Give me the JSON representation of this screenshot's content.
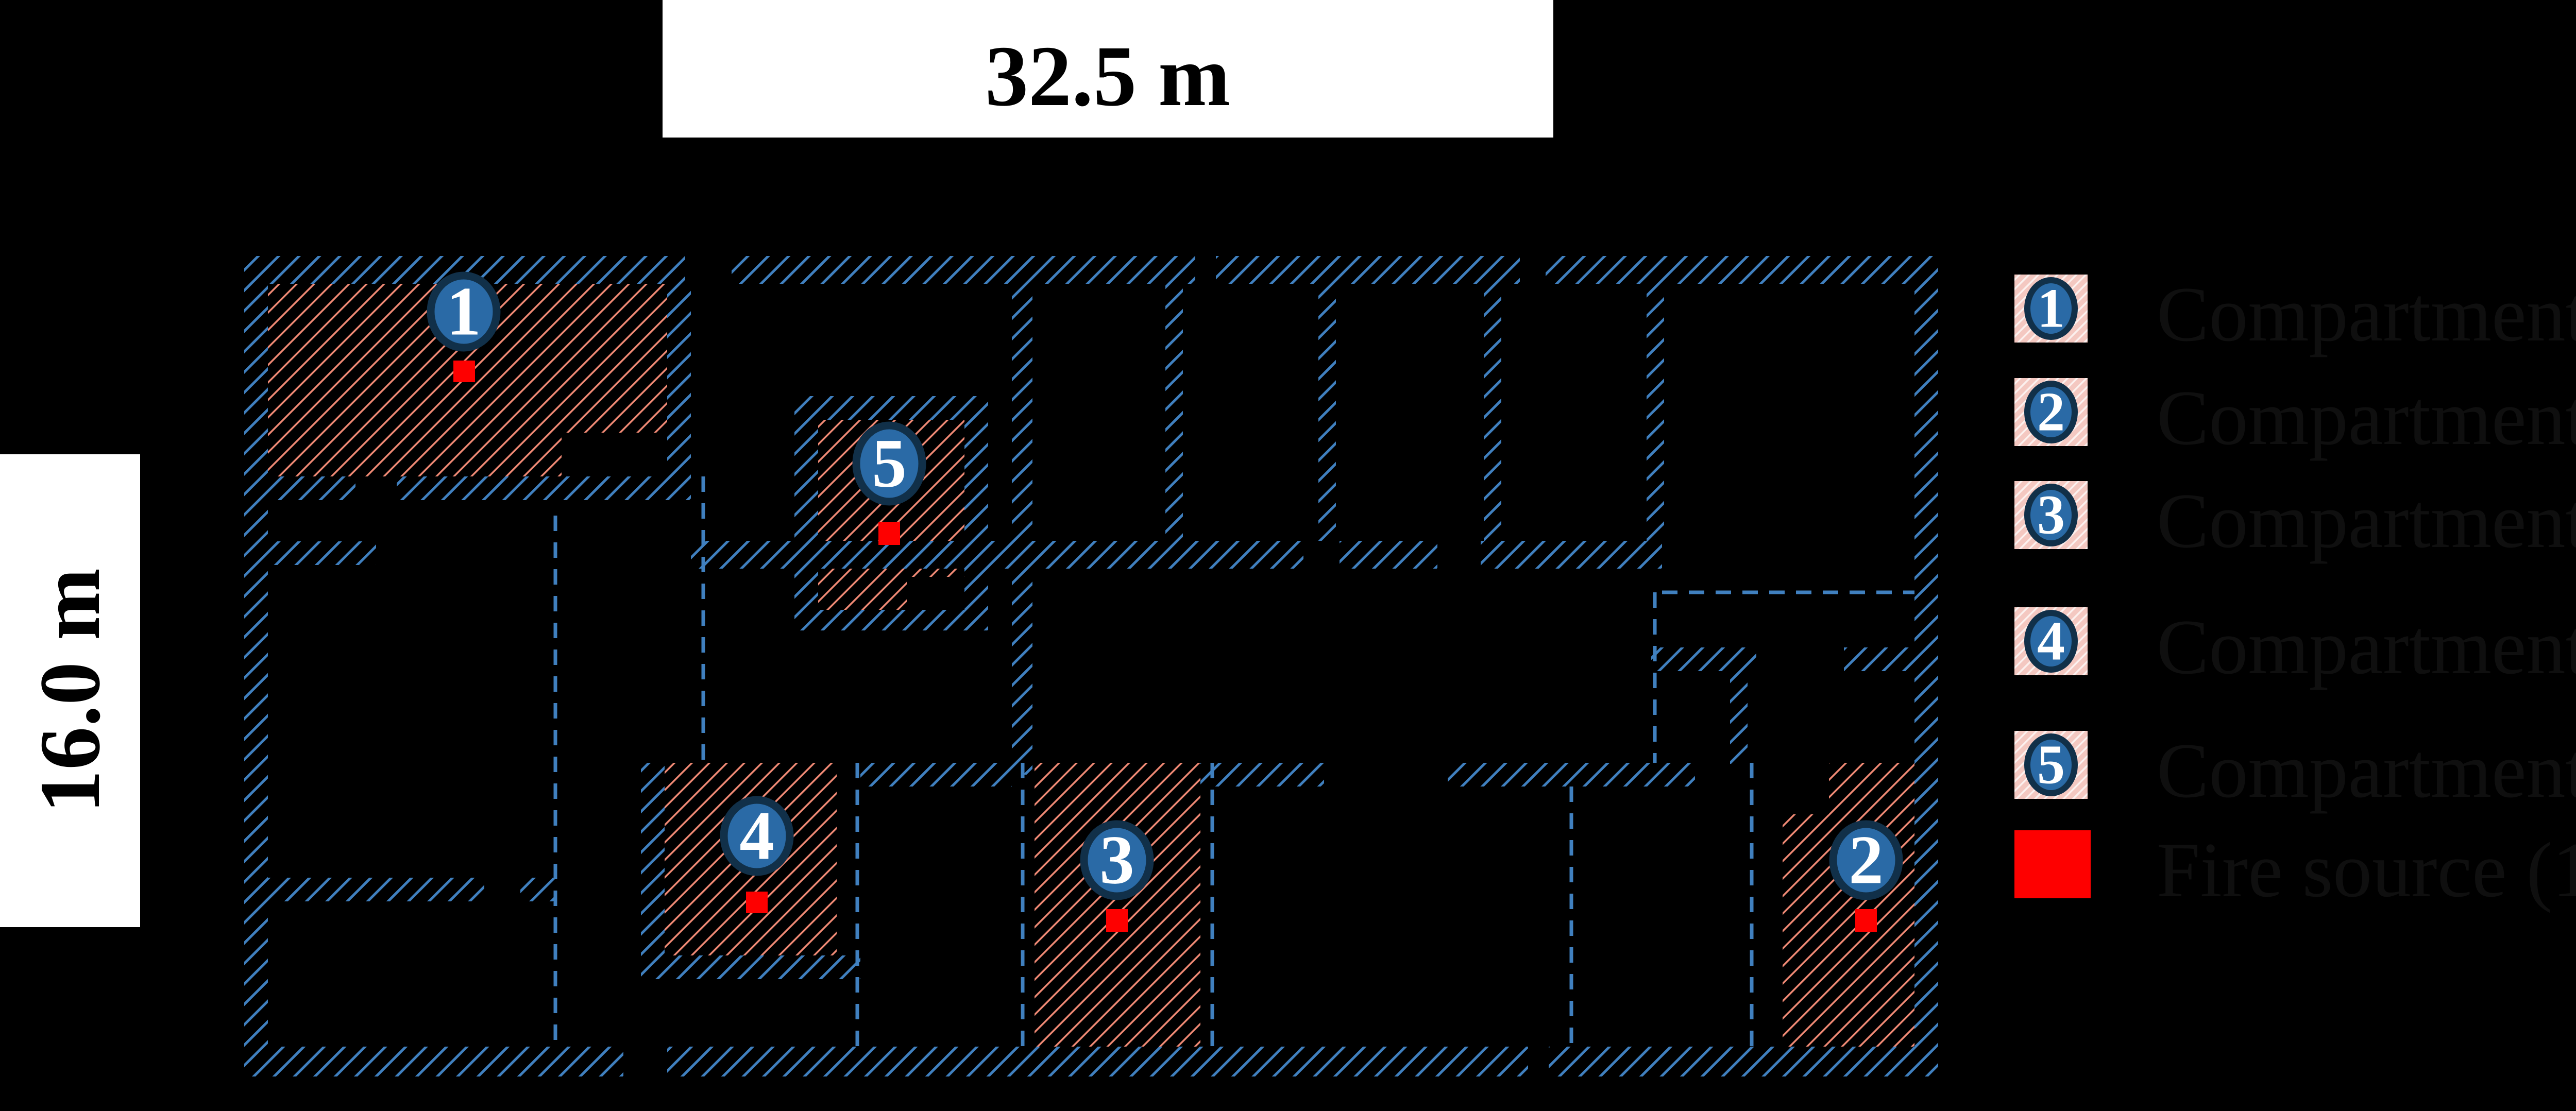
{
  "figure": {
    "type": "building-floor-plan",
    "background": "#000000",
    "width_label": "32.5 m",
    "height_label": "16.0 m"
  },
  "scale_bars": {
    "top": {
      "label": "32.5 m"
    },
    "left": {
      "label": "16.0 m"
    }
  },
  "legend": {
    "items": [
      {
        "number": "1",
        "label": "Compartment 1 (30.11 m²)",
        "swatch": "pink-hatched-with-badge"
      },
      {
        "number": "2",
        "label": "Compartment 2 (19.69 m²)",
        "swatch": "pink-hatched-with-badge"
      },
      {
        "number": "3",
        "label": "Compartment 3 (19.39 m²)",
        "swatch": "pink-hatched-with-badge"
      },
      {
        "number": "4",
        "label": "Compartment 4 (11.02 m²)",
        "swatch": "pink-hatched-with-badge"
      },
      {
        "number": "5",
        "label": "Compartment 5 (8.03 m²)",
        "swatch": "pink-hatched-with-badge"
      },
      {
        "number": "",
        "label": "Fire source (1 m²)",
        "swatch": "red-filled"
      }
    ]
  },
  "markers": [
    {
      "number": "1",
      "compartment": "Compartment 1"
    },
    {
      "number": "2",
      "compartment": "Compartment 2"
    },
    {
      "number": "3",
      "compartment": "Compartment 3"
    },
    {
      "number": "4",
      "compartment": "Compartment 4"
    },
    {
      "number": "5",
      "compartment": "Compartment 5"
    }
  ],
  "colors": {
    "wall_hatch_blue": "#4080bf",
    "compartment_hatch_salmon": "#f28b76",
    "marker_fill_blue": "#2a6aa6",
    "marker_ring_navy": "#113049",
    "legend_swatch_pink": "#f4c8c1",
    "fire_source_red": "#fe0000",
    "ruler_background": "#ffffff",
    "label_text": "#0f0f0f"
  }
}
